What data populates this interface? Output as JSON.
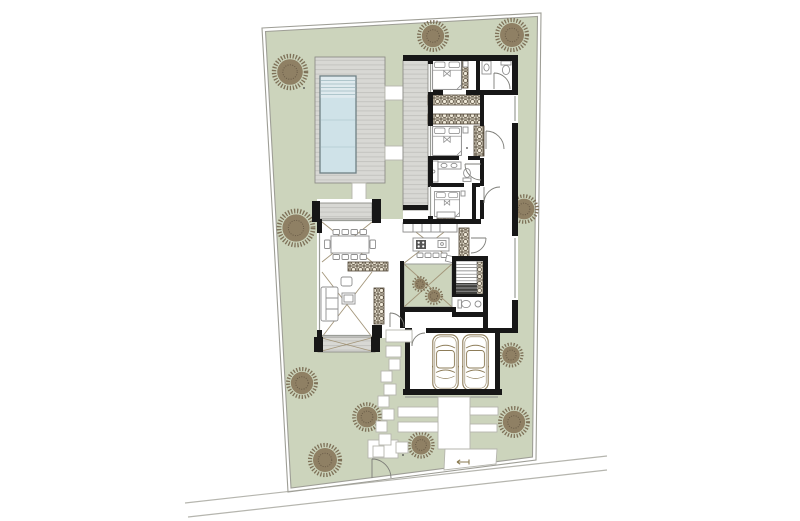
{
  "canvas": {
    "width": 800,
    "height": 521,
    "background": "#ffffff"
  },
  "palette": {
    "lot_green": "#ccd4bc",
    "boundary": "#9e9e96",
    "deck": "#d8d8d4",
    "deck_stripe": "#c4c4c0",
    "deck_border": "#8e8e88",
    "pool_water": "#cfe2e8",
    "pool_steps": "#dfeaee",
    "pool_border": "#6e7f83",
    "wall": "#171717",
    "furniture_line": "#8f8f8f",
    "glass_line": "#9a9d97",
    "x_line": "#a3967a",
    "cabinet_line": "#4d4232",
    "cabinet_fill": "#efe9d9",
    "tree_fill": "#8b7b5f",
    "tree_edge": "#74654b",
    "car_line": "#8d7c58",
    "pad_line": "#b5b5ad",
    "road_line": "#b5b5ae",
    "stair_dark": "#3f3f3c"
  },
  "site": {
    "boundary_outer": [
      [
        262,
        28
      ],
      [
        541,
        13
      ],
      [
        536,
        460
      ],
      [
        288,
        492
      ]
    ],
    "boundary_inner": [
      [
        265.5,
        31.5
      ],
      [
        537.5,
        16.5
      ],
      [
        532.5,
        457
      ],
      [
        291,
        488
      ]
    ],
    "road_lines": [
      [
        185,
        503,
        607,
        456
      ],
      [
        188,
        517,
        607,
        470
      ]
    ],
    "entry_marker": {
      "x": 457,
      "y": 462
    },
    "specks": [
      [
        304,
        88
      ],
      [
        403,
        455
      ],
      [
        467,
        148
      ]
    ]
  },
  "landscape": {
    "trees": [
      {
        "x": 290,
        "y": 72,
        "r": 16
      },
      {
        "x": 433,
        "y": 36,
        "r": 14
      },
      {
        "x": 512,
        "y": 35,
        "r": 15
      },
      {
        "x": 296,
        "y": 228,
        "r": 17
      },
      {
        "x": 524,
        "y": 209,
        "r": 13
      },
      {
        "x": 302,
        "y": 383,
        "r": 14
      },
      {
        "x": 367,
        "y": 417,
        "r": 13
      },
      {
        "x": 421,
        "y": 445,
        "r": 12
      },
      {
        "x": 325,
        "y": 460,
        "r": 15
      },
      {
        "x": 514,
        "y": 422,
        "r": 14
      },
      {
        "x": 511,
        "y": 355,
        "r": 11
      }
    ],
    "courtyard_shrubs": [
      {
        "x": 420,
        "y": 284,
        "r": 7
      },
      {
        "x": 434,
        "y": 296,
        "r": 8
      }
    ]
  },
  "pool": {
    "deck": [
      315,
      57,
      70,
      126
    ],
    "water": [
      320,
      76,
      36,
      97
    ],
    "step_lines_y": [
      80.5,
      84,
      87.5,
      91,
      94.5
    ],
    "lane_lines_y": [
      120,
      147
    ],
    "connector_pads": [
      [
        385,
        86,
        18,
        14
      ],
      [
        385,
        146,
        18,
        14
      ],
      [
        352,
        183,
        14,
        19
      ]
    ]
  },
  "hardscape": {
    "stepping_stones": [
      [
        386,
        346,
        15,
        11
      ],
      [
        389,
        359,
        11,
        11
      ],
      [
        381,
        371,
        11,
        11
      ],
      [
        384,
        384,
        12,
        11
      ],
      [
        378,
        396,
        11,
        11
      ],
      [
        382,
        409,
        12,
        11
      ],
      [
        376,
        421,
        11,
        11
      ],
      [
        379,
        434,
        12,
        11
      ],
      [
        373,
        446,
        11,
        11
      ],
      [
        396,
        442,
        12,
        11
      ]
    ],
    "porch": [
      386,
      330,
      26,
      12
    ],
    "gate_pad": [
      368,
      440,
      30,
      18
    ],
    "driveway_strips": [
      [
        438,
        397,
        32,
        52
      ],
      [
        398,
        407,
        40,
        10
      ],
      [
        398,
        422,
        40,
        10
      ],
      [
        470,
        407,
        28,
        8
      ],
      [
        470,
        424,
        27,
        8
      ]
    ],
    "driveway_apron": [
      [
        445,
        449
      ],
      [
        497,
        449
      ],
      [
        496,
        464
      ],
      [
        444,
        470
      ]
    ]
  },
  "storage_units": [
    [
      456,
      60,
      12,
      28
    ],
    [
      428,
      95,
      54,
      10
    ],
    [
      428,
      114,
      54,
      10
    ],
    [
      474,
      126,
      10,
      30
    ],
    [
      459,
      228,
      10,
      30
    ],
    [
      477,
      262,
      10,
      34
    ],
    [
      348,
      262,
      40,
      9
    ],
    [
      374,
      288,
      10,
      36
    ],
    [
      404,
      223,
      9,
      9
    ],
    [
      447,
      223,
      10,
      9
    ],
    [
      437,
      213,
      18,
      6
    ]
  ],
  "cars": [
    {
      "x": 432,
      "y": 334
    },
    {
      "x": 462,
      "y": 334
    }
  ]
}
